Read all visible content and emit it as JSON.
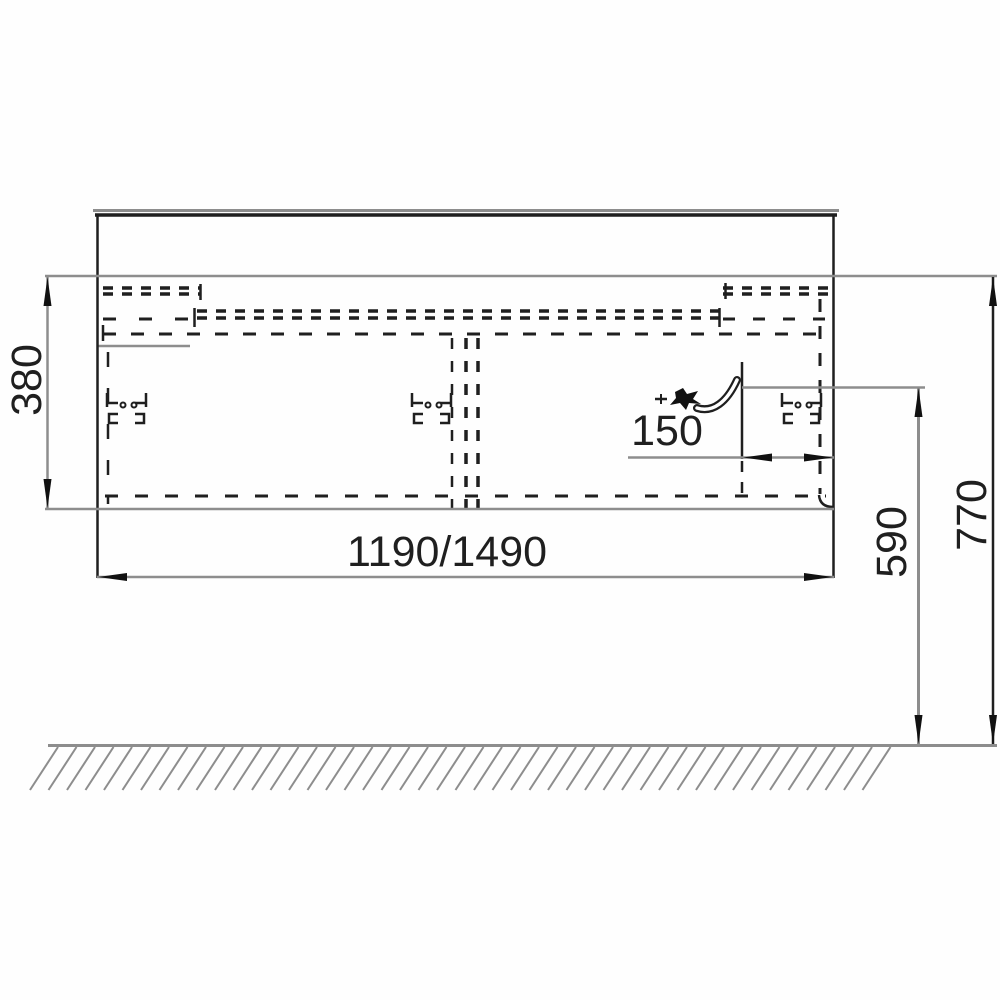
{
  "drawing": {
    "kind": "vanity-cabinet-installation-dimension-drawing",
    "labels": {
      "cabinet_height": "380",
      "cabinet_width": "1190/1490",
      "drain_offset_from_side": "150",
      "drain_height_from_floor": "590",
      "worktop_height_from_floor": "770"
    },
    "colors": {
      "line_dark": "#1f1f1f",
      "line_gray": "#8d8d8d",
      "arrow": "#111111",
      "text": "#1f1f1f",
      "background": "#fefefe"
    }
  }
}
